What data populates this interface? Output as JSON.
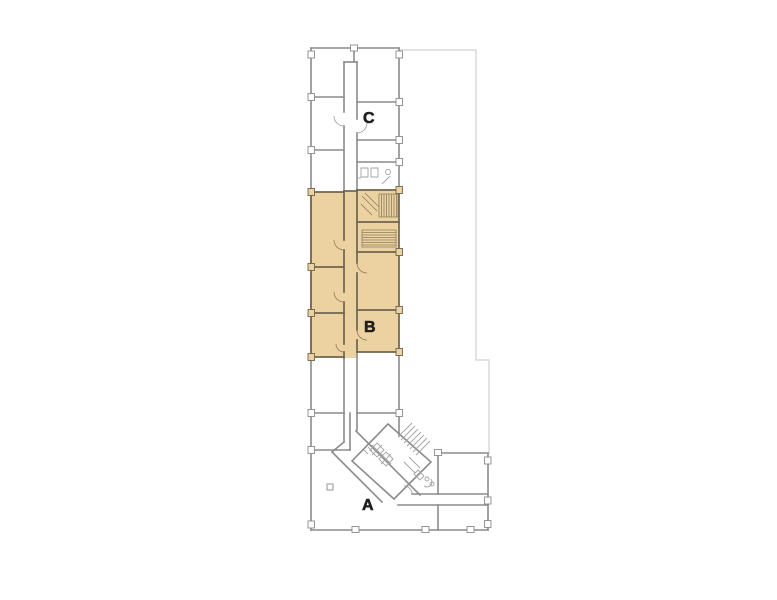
{
  "floor_plan": {
    "sections": [
      {
        "label": "A",
        "highlighted": false
      },
      {
        "label": "B",
        "highlighted": true
      },
      {
        "label": "C",
        "highlighted": false
      }
    ],
    "highlighted_section_label": "B",
    "colors": {
      "background": "#ffffff",
      "wall_gray": "#8b8b8b",
      "wall_light": "#d8d8d8",
      "detail_gray": "#a3a3a3",
      "highlight_fill": "#edd2a1",
      "highlight_wall": "#6e6450",
      "highlight_detail": "#8a7c5d",
      "label_color": "#1f1f1f"
    }
  }
}
